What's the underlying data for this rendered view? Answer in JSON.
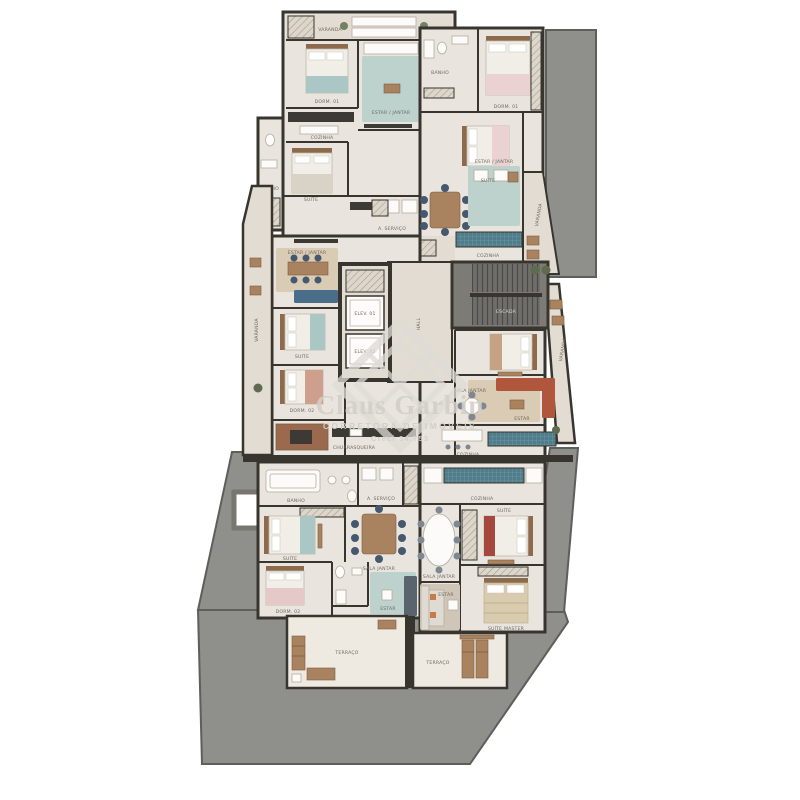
{
  "watermark": {
    "logo": "diamond-monogram",
    "name": "Claus Garbin",
    "tagline": "CORRETORA DE IMÓVEIS",
    "license": "Creci 34.753"
  },
  "plan": {
    "unit_top_left": {
      "rooms": [
        "VARANDA",
        "DORM. 01",
        "ESTAR / JANTAR",
        "COZINHA",
        "SUÍTE",
        "BANHO",
        "A. SERVIÇO"
      ]
    },
    "unit_top_right": {
      "rooms": [
        "DORM. 01",
        "SUÍTE",
        "ESTAR / JANTAR",
        "COZINHA",
        "VARANDA",
        "BANHO"
      ]
    },
    "unit_mid_left": {
      "rooms": [
        "VARANDA",
        "ESTAR / JANTAR",
        "SUÍTE",
        "DORM. 02",
        "CHURRASQUEIRA"
      ]
    },
    "unit_mid_right": {
      "rooms": [
        "SUÍTE",
        "ESTAR",
        "SALA JANTAR",
        "COZINHA",
        "VARANDA"
      ]
    },
    "unit_bottom_left": {
      "rooms": [
        "BANHO",
        "A. SERVIÇO",
        "SUÍTE",
        "SALA JANTAR",
        "DORM. 02",
        "ESTAR",
        "TERRAÇO"
      ]
    },
    "unit_bottom_right": {
      "rooms": [
        "COZINHA",
        "SALA JANTAR",
        "SUÍTE",
        "SUÍTE MASTER",
        "ESTAR",
        "TERRAÇO"
      ]
    },
    "core": {
      "rooms": [
        "HALL",
        "ELEV. 01",
        "ELEV. 02",
        "ESCADA"
      ]
    }
  },
  "colors": {
    "background": "#ffffff",
    "walls": "#38352f",
    "floor": "#e9e4dd",
    "common_gray": "#8f8f8c",
    "accent_teal": "#bdd2cd",
    "accent_blue": "#4a6e8a",
    "accent_terracotta": "#b0563c",
    "accent_pink": "#e9d2d1",
    "wood": "#a9825f",
    "watermark": "#d2cec7"
  }
}
